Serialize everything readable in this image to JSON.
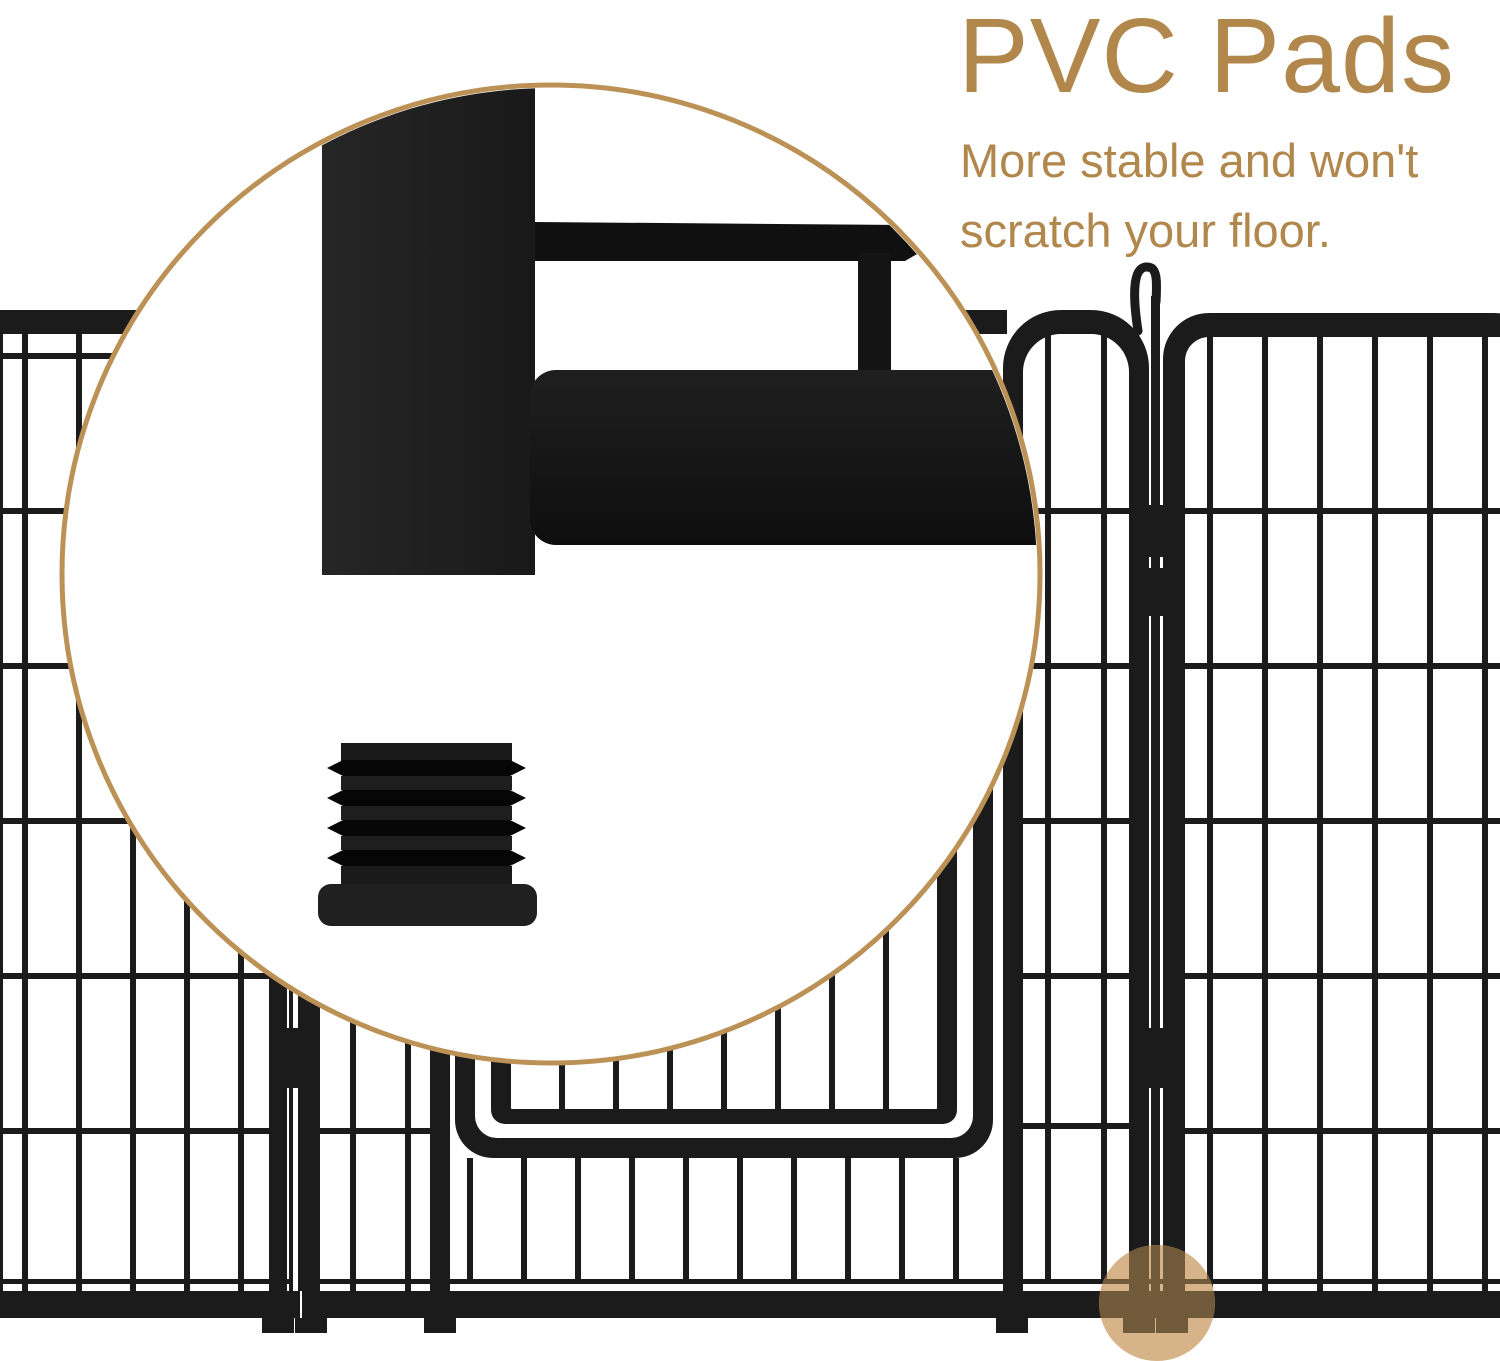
{
  "headline": {
    "title": "PVC Pads",
    "subtitle_line1": "More stable and won't",
    "subtitle_line2": "scratch your floor."
  },
  "colors": {
    "accent_text": "#b1874c",
    "magnifier_border": "#bb9156",
    "fence": "#1b1b1b",
    "highlight_fill": "#d7b38a",
    "highlight_bar_tint": "#715a3a"
  },
  "graphics": {
    "magnifier_circle": "magnified-detail-of-frame-post-and-pvc-pad",
    "pvc_pad": "ribbed-pvc-foot-pad",
    "fence": "metal-playpen-panels-with-gate",
    "latch_hook": "gate-latch-hook",
    "highlight_dot": "pad-location-highlight"
  }
}
